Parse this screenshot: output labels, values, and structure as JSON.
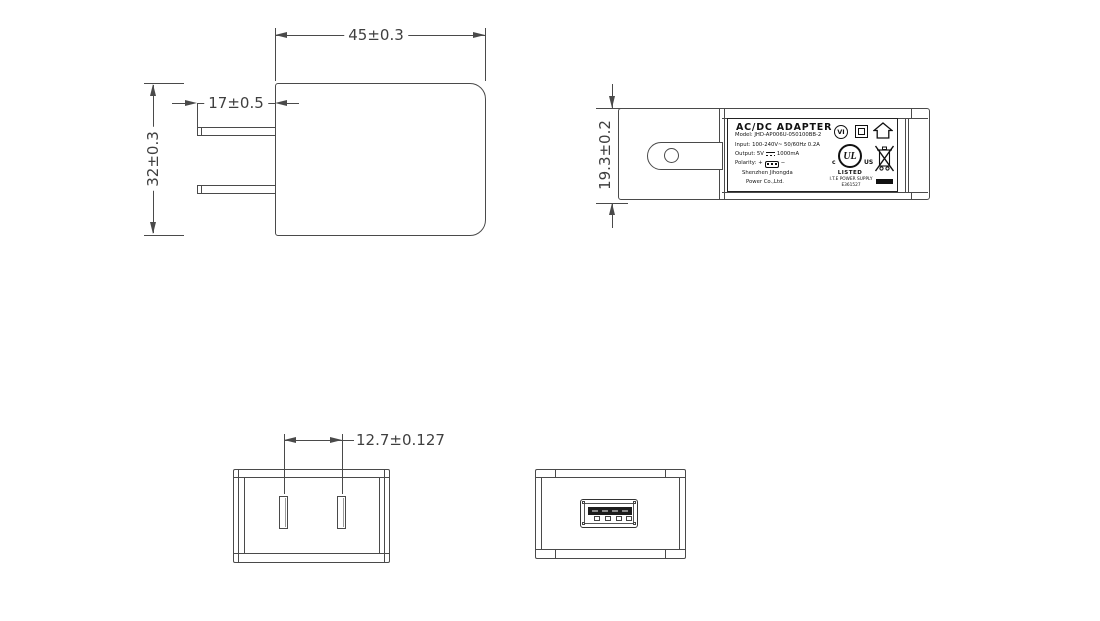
{
  "dimensions": {
    "front_width": "45±0.3",
    "prong_length": "17±0.5",
    "front_height": "32±0.3",
    "side_thickness": "19.3±0.2",
    "prong_spacing": "12.7±0.127"
  },
  "label": {
    "title": "AC/DC  ADAPTER",
    "model_line": "Model: JHD-AP006U-050100BB-2",
    "input_line": "Input: 100-240V~ 50/60Hz 0.2A",
    "output_prefix": "Output: 5V",
    "output_suffix": "1000mA",
    "polarity_label": "Polarity:",
    "polarity_plus": "+",
    "polarity_minus": "−",
    "company_line1": "Shenzhen Jihongda",
    "company_line2": "Power Co.,Ltd.",
    "efficiency_mark": "VI",
    "ul_mark": {
      "letters": "UL",
      "left": "c",
      "right": "US",
      "listed": "LISTED",
      "file_line1": "I.T.E POWER SUPPLY",
      "file_line2": "E361527"
    }
  },
  "colors": {
    "line": "#4a4a4a",
    "dim_text": "#3f3f3f",
    "label_text": "#111111",
    "background": "#ffffff"
  }
}
